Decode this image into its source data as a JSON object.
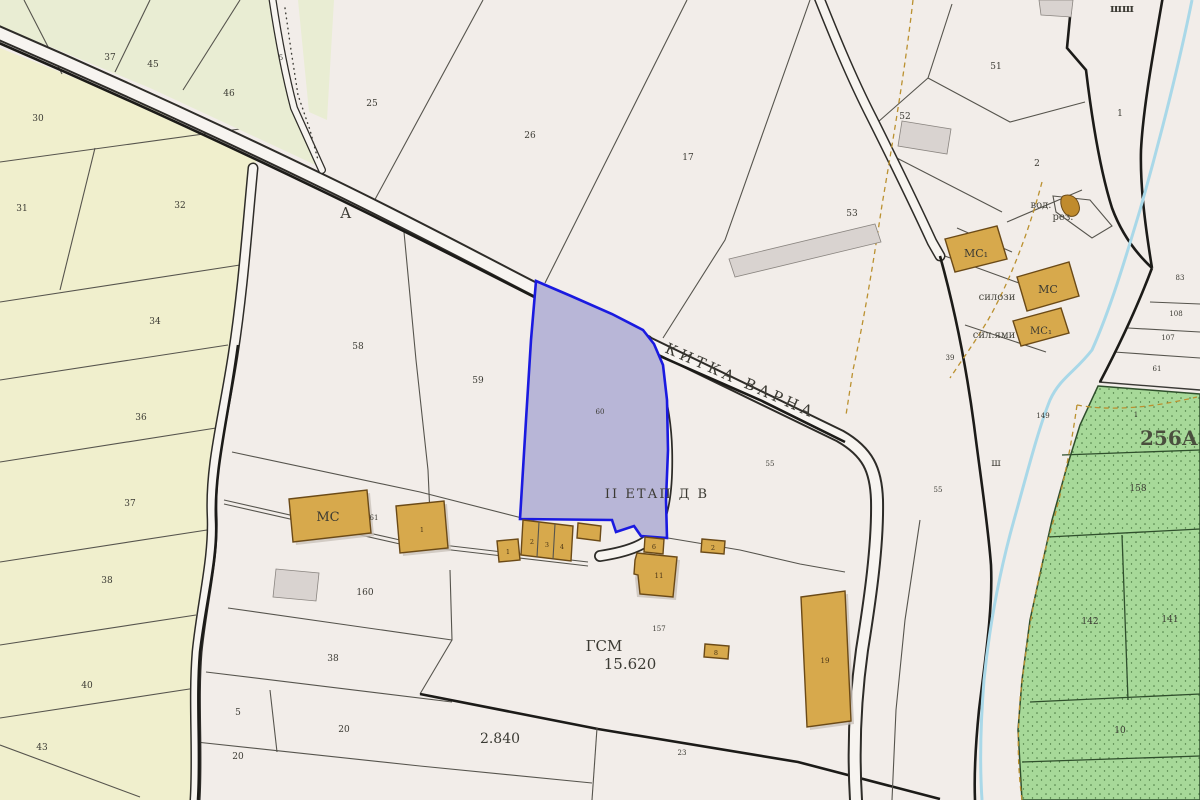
{
  "texts": {
    "road_a": "А",
    "kitka": "КИТКА ВАРНА",
    "etap": "II ЕТАП Д В",
    "gsm": "ГСМ",
    "gsm_val": "15.620",
    "val_2840": "2.840",
    "zone": "256А / 6",
    "vod": "вод.",
    "rez": "рез.",
    "silozi": "силози",
    "sil_yami": "сил.ями",
    "shsh": "шш",
    "sh": "ш"
  },
  "parcels": [
    "37",
    "45",
    "46",
    "5",
    "30",
    "31",
    "32",
    "34",
    "36",
    "37",
    "38",
    "40",
    "43",
    "25",
    "26",
    "17",
    "51",
    "52",
    "53",
    "2",
    "1",
    "58",
    "59",
    "60",
    "61",
    "55",
    "55",
    "39",
    "83",
    "108",
    "107",
    "61",
    "149",
    "1",
    "158",
    "142",
    "141",
    "10",
    "160",
    "38",
    "5",
    "20",
    "20",
    "23",
    "157"
  ],
  "buildings": [
    "МС",
    "МС₁",
    "МС",
    "МС₁",
    "1",
    "1",
    "2",
    "3",
    "4",
    "6",
    "11",
    "2",
    "8",
    "19"
  ],
  "colors": {
    "highlight_fill": "#b8b6d7",
    "highlight_stroke": "#1a1ae0",
    "field_yellow": "#f0efcd",
    "field_green": "#e9edd3",
    "forest_green": "#a7d999",
    "building_fill": "#d7a94c",
    "road_fill": "#f7f4f0",
    "stream": "#a9d8e8",
    "dashed_line": "#bb9130",
    "background": "#f2ede9"
  }
}
